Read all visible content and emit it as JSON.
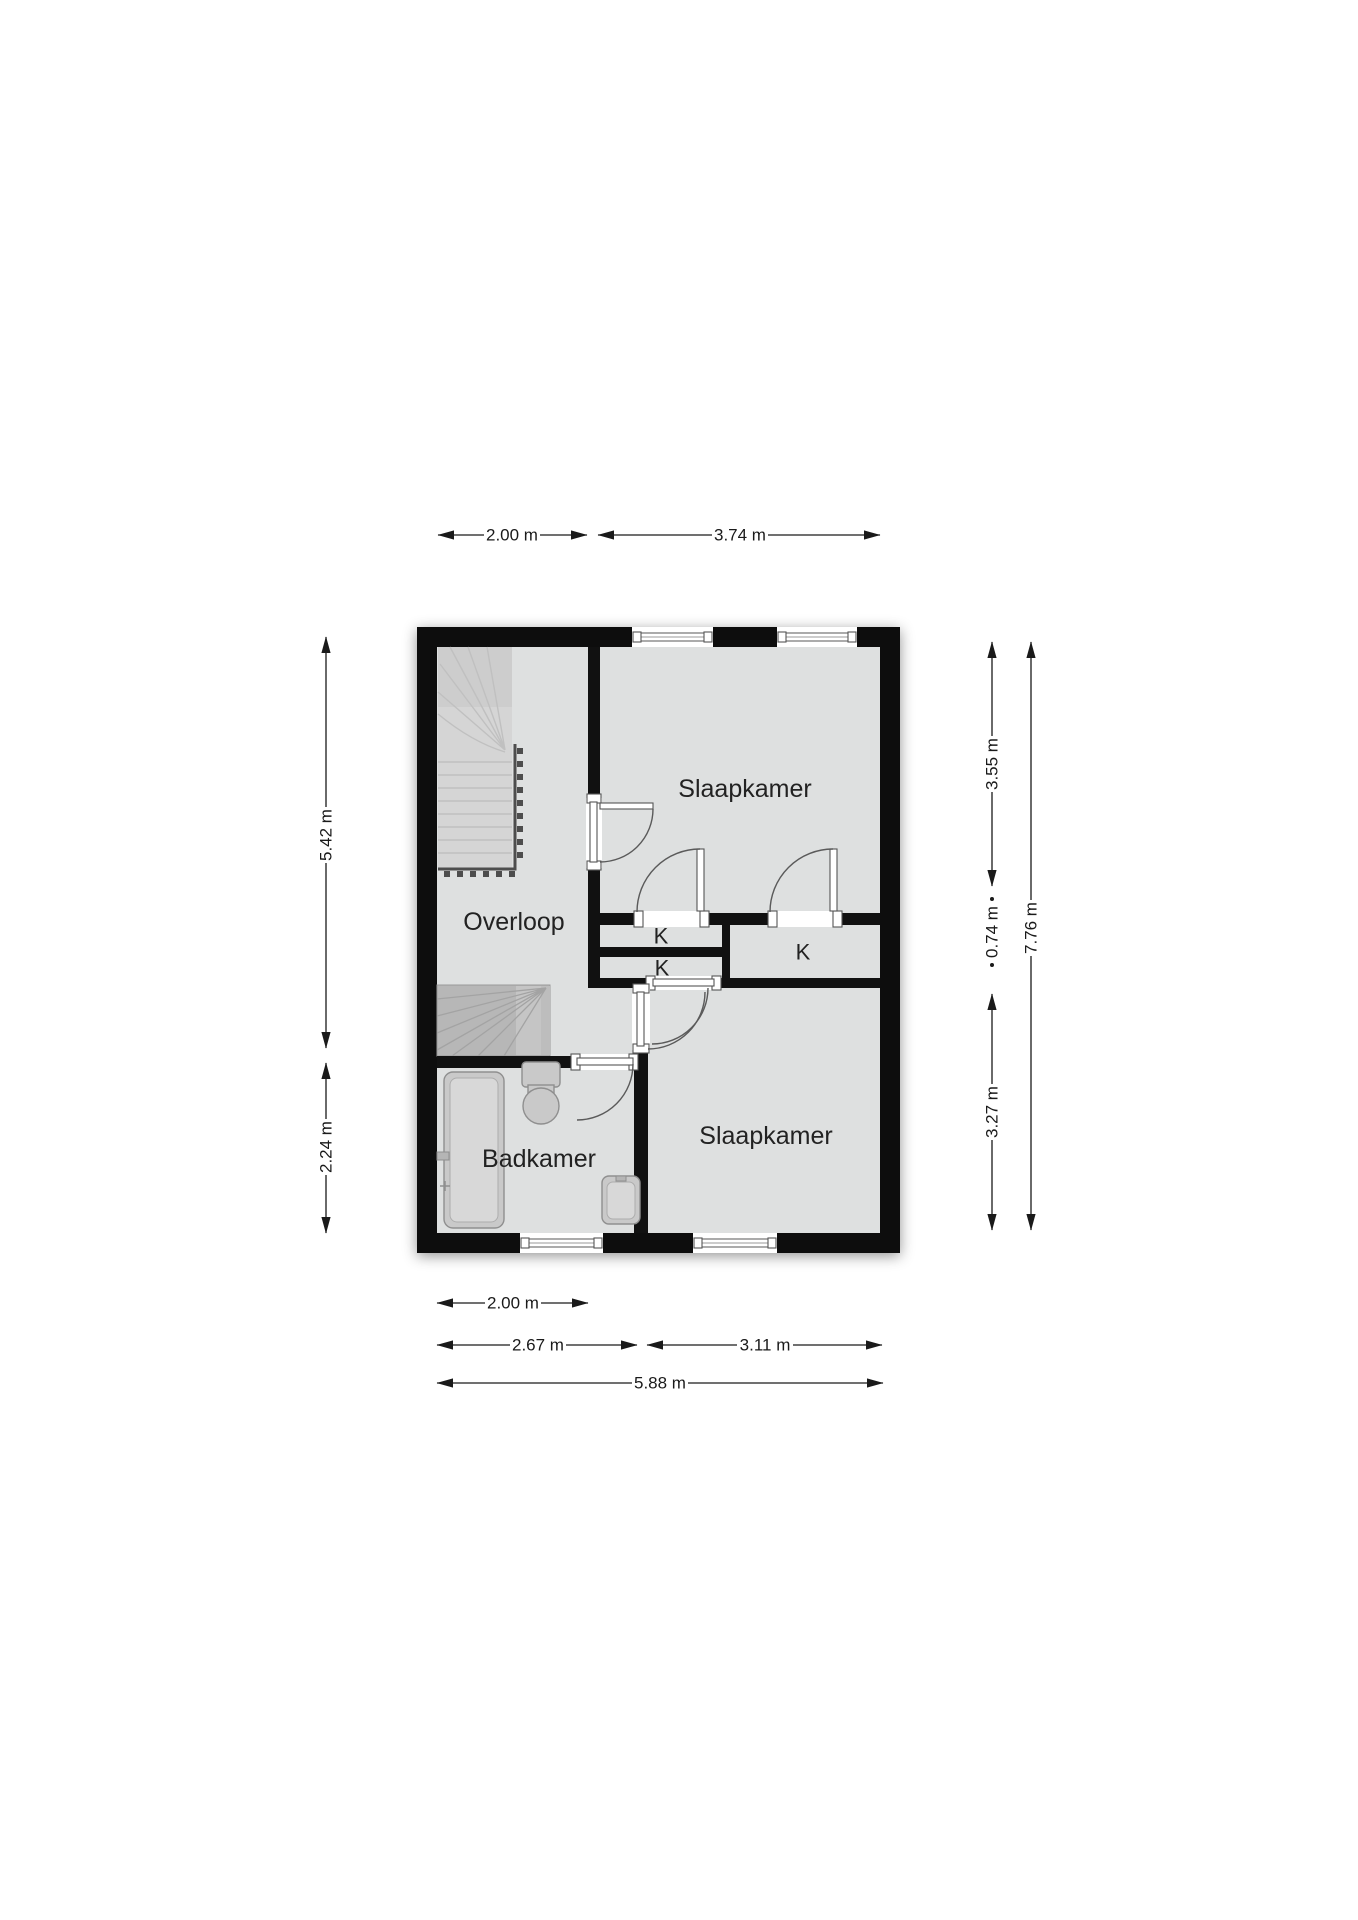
{
  "rooms": {
    "bedroom_top": "Slaapkamer",
    "landing": "Overloop",
    "closet_1": "K",
    "closet_2": "K",
    "closet_3": "K",
    "bathroom": "Badkamer",
    "bedroom_bottom": "Slaapkamer"
  },
  "dimensions": {
    "top": [
      "2.00 m",
      "3.74 m"
    ],
    "bottom": [
      "2.00 m",
      "2.67 m",
      "3.11 m",
      "5.88 m"
    ],
    "left": [
      "5.42 m",
      "2.24 m"
    ],
    "right": [
      "3.55 m",
      "0.74 m",
      "3.27 m",
      "7.76 m"
    ]
  },
  "colors": {
    "wall": "#111111",
    "floor": "#dee0e0",
    "dimension": "#1a1a1a",
    "stairs_light": "#d5d5d5",
    "stairs_dark": "#b7b7b7",
    "railing": "#4d4d4d",
    "fixture_fill": "#c9c9c9",
    "fixture_stroke": "#8f8f8f"
  }
}
